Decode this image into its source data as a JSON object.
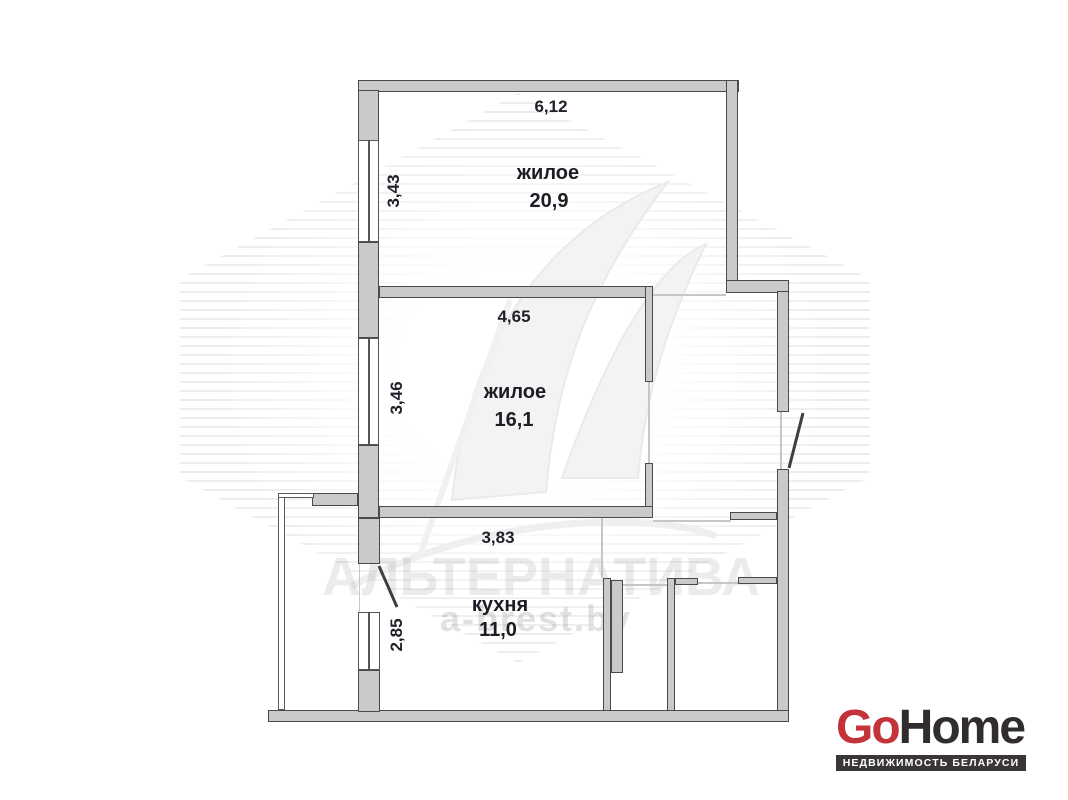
{
  "plan": {
    "rooms": [
      {
        "name": "жилое",
        "area": "20,9",
        "width_label": "6,12",
        "height_label": "3,43"
      },
      {
        "name": "жилое",
        "area": "16,1",
        "width_label": "4,65",
        "height_label": "3,46"
      },
      {
        "name": "кухня",
        "area": "11,0",
        "width_label": "3,83",
        "height_label": "2,85"
      }
    ]
  },
  "watermark": {
    "agency": "АЛЬТЕРНАТИВА",
    "site": "a-brest.by"
  },
  "logo": {
    "go": "Go",
    "home": "Home",
    "tagline": "НЕДВИЖИМОСТЬ БЕЛАРУСИ",
    "go_color": "#c5333a",
    "home_color": "#312d2e",
    "bar_bg": "#3a3637"
  },
  "colors": {
    "wall_fill": "#cacaca",
    "wall_border": "#4a4a4a",
    "label_text": "#20202a"
  }
}
